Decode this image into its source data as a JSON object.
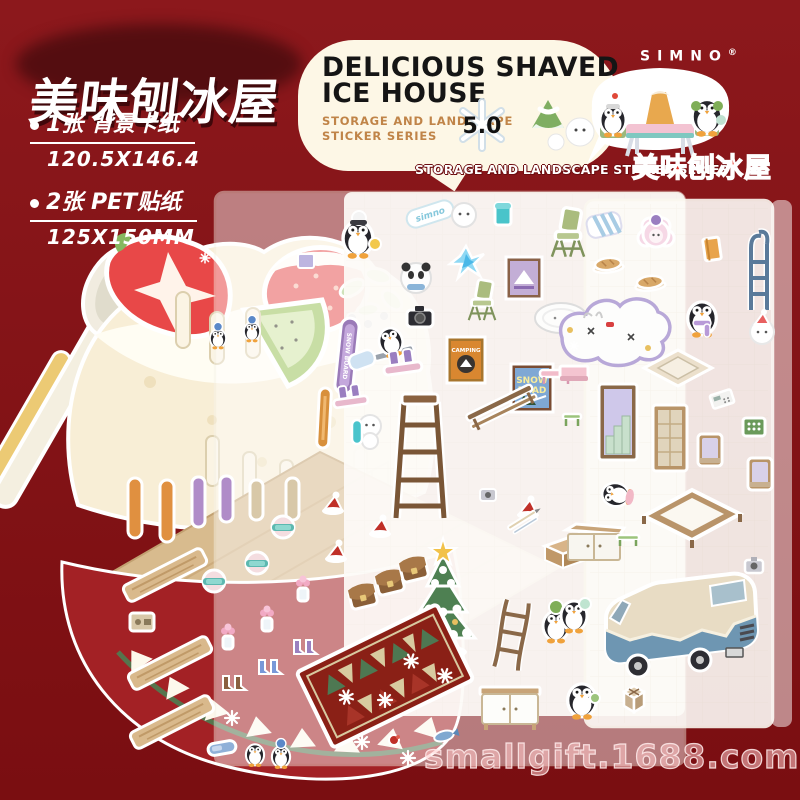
{
  "page": {
    "bg_top": "#8c181c",
    "bg_bottom": "#7a0e11",
    "accent_red": "#e8372b",
    "bubble_cream": "#fdf7e6"
  },
  "header": {
    "title": "美味刨冰屋",
    "specs": [
      {
        "label": "1张 背景卡纸",
        "value": "120.5X146.4"
      },
      {
        "label": "2张 PET贴纸",
        "value": "125X150MM"
      }
    ]
  },
  "bubble": {
    "title_line1": "DELICIOUS SHAVED",
    "title_line2": "ICE HOUSE",
    "subtitle_line1": "STORAGE AND LANDSCAPE",
    "subtitle_line2": "STICKER SERIES",
    "version": "5.0"
  },
  "brand": {
    "name": "SIMNO",
    "reg": "®"
  },
  "series": {
    "caption": "STORAGE AND LANDSCAPE STICKER SERIES",
    "title_cn": "美味刨冰屋"
  },
  "watermark": "smallgift.1688.com",
  "sticker_texts": {
    "capsule_brand": "simno",
    "sign_line1": "SNOW",
    "sign_line2": "ROAD",
    "poster_label": "CAMPING",
    "snowboard_label": "SNOW BOARD"
  },
  "product": {
    "background_card_items": [
      "spoon",
      "shaved-ice-mound",
      "strawberry-half",
      "strawberry",
      "kiwi-slice",
      "mint-leaves",
      "blueberries",
      "butter-cubes",
      "empty-slots",
      "striped-wall",
      "wooden-floor",
      "red-bowl-zigzag-rim"
    ],
    "sheet1_items": [
      "penguin-beanie-duck",
      "simno-capsule",
      "snowball-face",
      "teal-cup",
      "camp-chair",
      "panda-scarf",
      "ice-crystal",
      "camping-poster-purple",
      "camping-poster-orange",
      "snow-road-sign",
      "snowboard",
      "orange-board",
      "penguin-snowboarder",
      "black-camera",
      "sled-boots",
      "blue-pillow",
      "oval-rug",
      "pink-bench",
      "wood-railing",
      "step-ladder",
      "snowman",
      "christmas-tree",
      "ski-capsules",
      "helmets",
      "flower-vases",
      "snow-boots",
      "wood-planks",
      "radio-box",
      "santa-hats",
      "satchel-bags",
      "christmas-rug",
      "counter-shelf",
      "rope-ladder",
      "penguin-green-hat",
      "white-cabinet",
      "tools",
      "gray-camera",
      "penguin-pair",
      "goggles",
      "snowflakes"
    ],
    "sheet2_items": [
      "striped-pillow",
      "pink-sheep",
      "orange-book",
      "metal-ladder",
      "bread-loaves",
      "penguin-purple-scarf",
      "cloud-rug",
      "white-bear-pink-hat",
      "floor-mat",
      "calculator",
      "green-phone",
      "green-stool",
      "pink-table",
      "door-with-stairs",
      "lattice-door",
      "windows",
      "bed-frame",
      "white-cabinet",
      "green-bench",
      "penguin-mint",
      "camper-van",
      "camera",
      "penguin-walking",
      "gift-box",
      "penguin-lying"
    ]
  }
}
